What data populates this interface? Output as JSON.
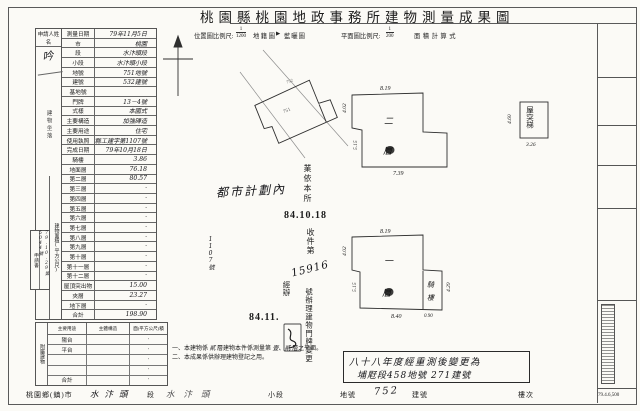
{
  "colors": {
    "ink": "#1c1c1c",
    "paper": "#fbfaf6",
    "line": "#555555"
  },
  "title": "桃園縣桃園地政事務所建物測量成果圖",
  "scale": {
    "loc_label": "位置圖比例尺:",
    "loc_frac_num": "1",
    "loc_frac_den": "1200",
    "cadastral_label": "地籍圖",
    "marker": "▶",
    "blueprint_label": "藍曬圖",
    "plan_label": "平面圖比例尺:",
    "plan_frac_num": "1",
    "plan_frac_den": "200",
    "area_calc_label": "面積計算式"
  },
  "form": {
    "applicant_label": "申請人姓名",
    "applicant_signature": "吟",
    "group_location": "建物坐落",
    "group_area": "建物面積(平方公尺)",
    "receipt_label": "申請書",
    "receipt_date": "79.10.29",
    "receipt_no": "第5044號",
    "rows": [
      {
        "l": "測量日期",
        "v": "79年11月5日"
      },
      {
        "l": "市",
        "v": "桃園"
      },
      {
        "l": "段",
        "v": "水汴頭段"
      },
      {
        "l": "小段",
        "v": "水汴頭小段"
      },
      {
        "l": "地號",
        "v": "751地號"
      },
      {
        "l": "建號",
        "v": "532建號"
      },
      {
        "l": "基地號",
        "v": ""
      },
      {
        "l": "門牌",
        "v": "13－4號"
      },
      {
        "l": "式樣",
        "v": "本國式"
      },
      {
        "l": "主要構造",
        "v": "加強磚造"
      },
      {
        "l": "主要用途",
        "v": "住宅"
      },
      {
        "l": "使用執照",
        "v": "桃縣工建字第1107號"
      },
      {
        "l": "完成日期",
        "v": "79年10月18日"
      },
      {
        "l": "騎樓",
        "v": "3.86"
      },
      {
        "l": "地面層",
        "v": "76.18"
      },
      {
        "l": "第二層",
        "v": "80.57"
      },
      {
        "l": "第三層",
        "v": "·"
      },
      {
        "l": "第四層",
        "v": "·"
      },
      {
        "l": "第五層",
        "v": "·"
      },
      {
        "l": "第六層",
        "v": "·"
      },
      {
        "l": "第七層",
        "v": "·"
      },
      {
        "l": "第八層",
        "v": "·"
      },
      {
        "l": "第九層",
        "v": "·"
      },
      {
        "l": "第十層",
        "v": "·"
      },
      {
        "l": "第十一層",
        "v": "·"
      },
      {
        "l": "第十二層",
        "v": "·"
      },
      {
        "l": "屋頂突出物",
        "v": "15.00"
      },
      {
        "l": "夾層",
        "v": "23.27"
      },
      {
        "l": "地下層",
        "v": "·"
      },
      {
        "l": "合計",
        "v": "198.90"
      }
    ]
  },
  "annex": {
    "group": "附屬建物",
    "headers": [
      "主要用途",
      "主體構造",
      "面(平方公尺)積"
    ],
    "rows": [
      {
        "a": "陽台",
        "b": "",
        "c": "·"
      },
      {
        "a": "平台",
        "b": "",
        "c": "·"
      },
      {
        "a": "",
        "b": "",
        "c": "·"
      },
      {
        "a": "",
        "b": "",
        "c": "·"
      },
      {
        "a": "合計",
        "b": "",
        "c": "·"
      }
    ]
  },
  "notes_vertical": [
    {
      "t": "一、本建物平面圖係依使用執照竣工平面圖轉繪"
    },
    {
      "t": "二、本案建物係依竣工圖說轉繪 字第 號"
    },
    {
      "t": "三、都市計劃樁豎立實施日期 年 月 日"
    }
  ],
  "notes_vertical_fill": "1107號",
  "urban_plan_note": "都市計劃內",
  "stamps": {
    "received_by": "業依本所",
    "date1": "84.10.18",
    "receipt_no_label": "收件第",
    "receipt_number": "15916",
    "action": "號辦理建物門牌變更",
    "handler": "經辦",
    "date2": "84.11."
  },
  "plans": {
    "p2": {
      "char1": "二",
      "char2": "層",
      "dim_top": "8.19",
      "dim_left_upper": "4.02",
      "dim_left_lower": "5.15",
      "dim_bottom": "7.39"
    },
    "p1": {
      "char1": "一",
      "char2": "層",
      "dim_top": "8.19",
      "dim_left_upper": "4.02",
      "dim_left_lower": "5.15",
      "dim_bottom": "8.40",
      "arcade_char1": "騎",
      "arcade_char2": "樓",
      "dim_arcade_right": "4.29",
      "dim_arcade_bottom": "0.90"
    },
    "roof_stair": {
      "label": "屋突梯",
      "dim_left": "4.60",
      "dim_bottom": "3.26"
    },
    "sketch": {
      "label_inner": "751",
      "label_outer": "752"
    }
  },
  "calc": {
    "lines": [
      {
        "t": "騎樓:0.90×4.29=3.86"
      },
      {
        "t": "壹層:8.19×4.02+8.40×5.15=76.18"
      },
      {
        "t": "貳層:8.19×4.02+9.25×5.15=80.57"
      },
      {
        "t": "夾層:4.79×4.86=23.27"
      },
      {
        "t": "屋突梯:4.60×3.26=15.00"
      },
      {
        "t": "合計:198.90"
      }
    ]
  },
  "resurvey_note": {
    "line1": "八十八年度經重測後變更為",
    "line2": "埔屘段458地號 271建號"
  },
  "bottom_notes": {
    "n1_pre": "一、本建物係",
    "n1_fill1": "貳",
    "n1_mid": "層建物本件係測量第",
    "n1_fill2": "壹、貳",
    "n1_post": "層之平面。",
    "n2": "二、本成果係供辦理建物登記之用。"
  },
  "bottom_strip": {
    "county": "桃園鄉(鎮)市",
    "section_value": "水汴頭",
    "section_label": "段",
    "subsection_value": "水汴頭",
    "subsection_label": "小段",
    "parcel_label": "地號",
    "parcel_value": "752",
    "building_label": "建號",
    "floor_label": "樓次"
  },
  "right_column": {
    "cells": [
      {
        "t": "收件"
      },
      {
        "t": "檢查"
      },
      {
        "t": "成果"
      },
      {
        "t": "計算"
      }
    ],
    "print_code": "79.4.6,500"
  }
}
